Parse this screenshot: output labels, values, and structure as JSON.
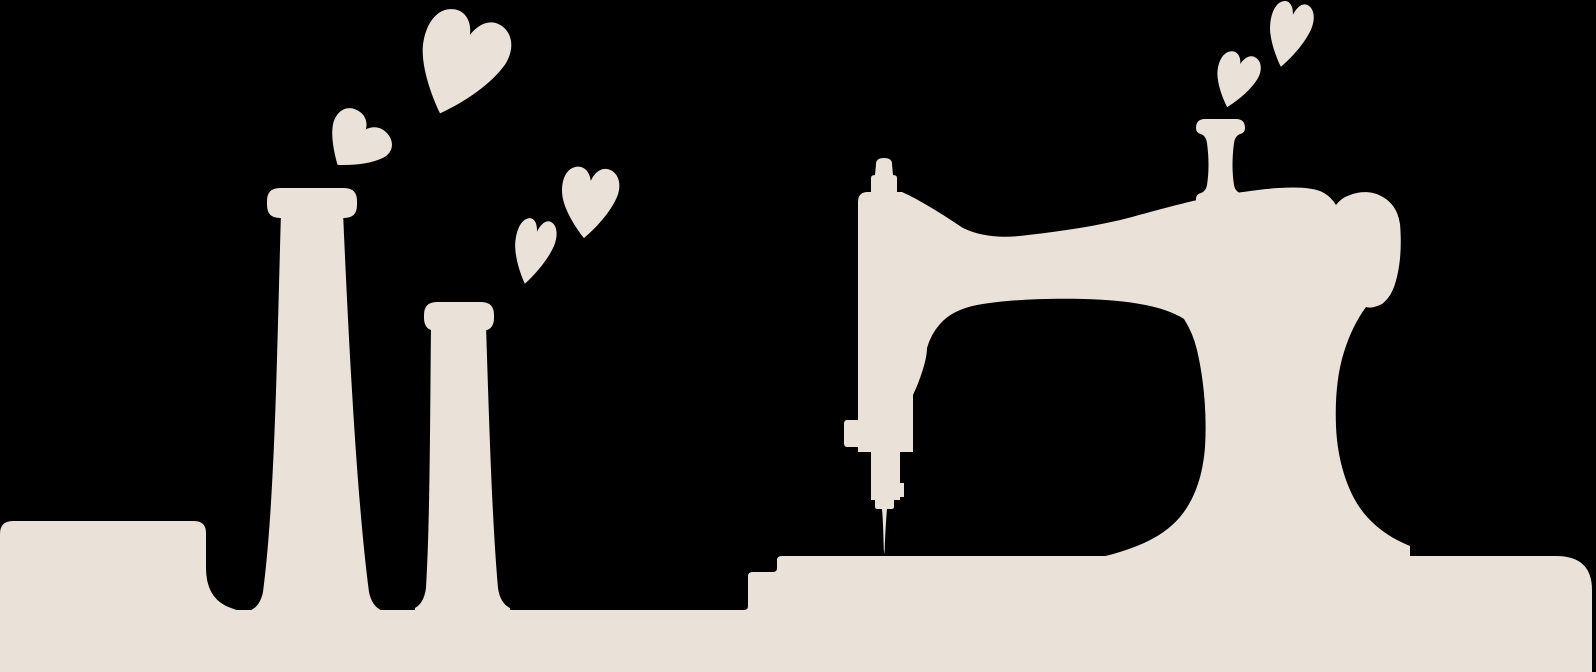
{
  "illustration": {
    "kind": "silhouette-clipart",
    "subject": "sewing scene: pincushion box, two thread spools and a vintage sewing machine on a table with floating hearts",
    "left_group_elements": [
      "pincushion-box",
      "tall-thread-spool",
      "short-thread-spool",
      "large-heart",
      "tilted-small-heart",
      "mid-upper-heart",
      "mid-lower-heart"
    ],
    "right_group_elements": [
      "vintage-sewing-machine",
      "machine-spool-pin",
      "hand-wheel",
      "needle-bar",
      "needle",
      "upper-heart",
      "lower-heart"
    ],
    "base_element": "table-base"
  },
  "colors": {
    "background": "#000000",
    "silhouette": "#EAE1D8"
  }
}
